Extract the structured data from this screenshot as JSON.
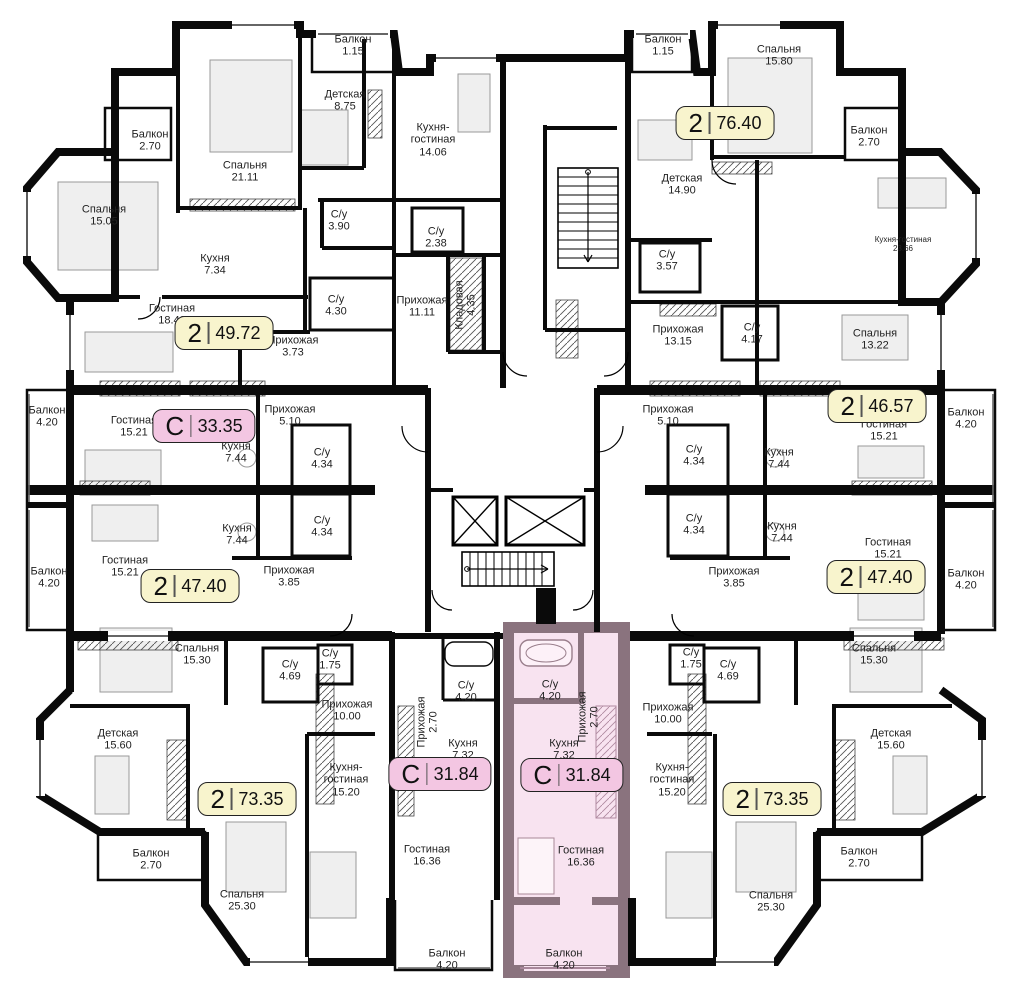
{
  "plan": {
    "name": "residential-floor-plan",
    "colors": {
      "walls": "#0a0a0a",
      "badge_two": "#f8f4cd",
      "badge_studio": "#f3c6e2",
      "highlight_fill": "#f8e3f0",
      "highlight_wall": "#8a737e"
    },
    "badges": [
      {
        "type": "2",
        "area": "49.72",
        "x": 224,
        "y": 333,
        "variant": "two",
        "highlighted": false
      },
      {
        "type": "С",
        "area": "33.35",
        "x": 204,
        "y": 426,
        "variant": "studio",
        "highlighted": false
      },
      {
        "type": "2",
        "area": "47.40",
        "x": 190,
        "y": 586,
        "variant": "two",
        "highlighted": false
      },
      {
        "type": "2",
        "area": "76.40",
        "x": 725,
        "y": 123,
        "variant": "two",
        "highlighted": false
      },
      {
        "type": "2",
        "area": "46.57",
        "x": 877,
        "y": 406,
        "variant": "two",
        "highlighted": false
      },
      {
        "type": "2",
        "area": "47.40",
        "x": 876,
        "y": 577,
        "variant": "two",
        "highlighted": false
      },
      {
        "type": "2",
        "area": "73.35",
        "x": 247,
        "y": 799,
        "variant": "two",
        "highlighted": false
      },
      {
        "type": "С",
        "area": "31.84",
        "x": 440,
        "y": 774,
        "variant": "studio",
        "highlighted": false
      },
      {
        "type": "С",
        "area": "31.84",
        "x": 572,
        "y": 775,
        "variant": "studio",
        "highlighted": true
      },
      {
        "type": "2",
        "area": "73.35",
        "x": 772,
        "y": 799,
        "variant": "two",
        "highlighted": false
      }
    ],
    "rooms": [
      {
        "name": "Балкон",
        "area": "2.70",
        "x": 150,
        "y": 141
      },
      {
        "name": "Спальня",
        "area": "21.11",
        "x": 245,
        "y": 172
      },
      {
        "name": "Спальня",
        "area": "15.05",
        "x": 104,
        "y": 216
      },
      {
        "name": "Кухня",
        "area": "7.34",
        "x": 215,
        "y": 265
      },
      {
        "name": "Гостиная",
        "area": "18.49",
        "x": 172,
        "y": 315
      },
      {
        "name": "Прихожая",
        "area": "3.73",
        "x": 293,
        "y": 347
      },
      {
        "name": "Балкон",
        "area": "1.15",
        "x": 353,
        "y": 46
      },
      {
        "name": "Детская",
        "area": "8.75",
        "x": 345,
        "y": 101
      },
      {
        "name": "Кухня-\nгостиная",
        "area": "14.06",
        "x": 433,
        "y": 140
      },
      {
        "name": "С/у",
        "area": "3.90",
        "x": 339,
        "y": 221
      },
      {
        "name": "С/у",
        "area": "2.38",
        "x": 436,
        "y": 238
      },
      {
        "name": "С/у",
        "area": "4.30",
        "x": 336,
        "y": 306
      },
      {
        "name": "Прихожая",
        "area": "11.11",
        "x": 422,
        "y": 307
      },
      {
        "name": "Кладовая",
        "area": "4.35",
        "x": 466,
        "y": 305,
        "vertical": true
      },
      {
        "name": "Балкон",
        "area": "1.15",
        "x": 663,
        "y": 46
      },
      {
        "name": "Детская",
        "area": "14.90",
        "x": 682,
        "y": 185
      },
      {
        "name": "С/у",
        "area": "3.57",
        "x": 667,
        "y": 261
      },
      {
        "name": "Спальня",
        "area": "15.80",
        "x": 779,
        "y": 56
      },
      {
        "name": "Балкон",
        "area": "2.70",
        "x": 869,
        "y": 137
      },
      {
        "name": "Кухня-гостиная",
        "area": "23.66",
        "x": 903,
        "y": 245,
        "small": true
      },
      {
        "name": "Прихожая",
        "area": "13.15",
        "x": 678,
        "y": 336
      },
      {
        "name": "С/у",
        "area": "4.17",
        "x": 752,
        "y": 334
      },
      {
        "name": "Прихожая",
        "area": "5.10",
        "x": 668,
        "y": 416
      },
      {
        "name": "С/у",
        "area": "4.34",
        "x": 694,
        "y": 456
      },
      {
        "name": "Кухня",
        "area": "7.44",
        "x": 779,
        "y": 459
      },
      {
        "name": "Спальня",
        "area": "13.22",
        "x": 875,
        "y": 340
      },
      {
        "name": "Гостиная",
        "area": "15.21",
        "x": 884,
        "y": 431
      },
      {
        "name": "Балкон",
        "area": "4.20",
        "x": 966,
        "y": 419
      },
      {
        "name": "С/у",
        "area": "4.34",
        "x": 694,
        "y": 525
      },
      {
        "name": "Кухня",
        "area": "7.44",
        "x": 782,
        "y": 533
      },
      {
        "name": "Гостиная",
        "area": "15.21",
        "x": 888,
        "y": 549
      },
      {
        "name": "Прихожая",
        "area": "3.85",
        "x": 734,
        "y": 578
      },
      {
        "name": "Балкон",
        "area": "4.20",
        "x": 966,
        "y": 580
      },
      {
        "name": "Балкон",
        "area": "4.20",
        "x": 47,
        "y": 417
      },
      {
        "name": "Гостиная",
        "area": "15.21",
        "x": 134,
        "y": 427
      },
      {
        "name": "Кухня",
        "area": "7.44",
        "x": 236,
        "y": 453
      },
      {
        "name": "С/у",
        "area": "4.34",
        "x": 322,
        "y": 459
      },
      {
        "name": "Прихожая",
        "area": "5.10",
        "x": 290,
        "y": 416
      },
      {
        "name": "Балкон",
        "area": "4.20",
        "x": 49,
        "y": 578
      },
      {
        "name": "Гостиная",
        "area": "15.21",
        "x": 125,
        "y": 567
      },
      {
        "name": "Кухня",
        "area": "7.44",
        "x": 237,
        "y": 535
      },
      {
        "name": "С/у",
        "area": "4.34",
        "x": 322,
        "y": 527
      },
      {
        "name": "Прихожая",
        "area": "3.85",
        "x": 289,
        "y": 577
      },
      {
        "name": "Спальня",
        "area": "15.30",
        "x": 197,
        "y": 655
      },
      {
        "name": "Детская",
        "area": "15.60",
        "x": 118,
        "y": 740
      },
      {
        "name": "Балкон",
        "area": "2.70",
        "x": 151,
        "y": 860
      },
      {
        "name": "Спальня",
        "area": "25.30",
        "x": 242,
        "y": 901
      },
      {
        "name": "С/у",
        "area": "4.69",
        "x": 290,
        "y": 671
      },
      {
        "name": "С/у",
        "area": "1.75",
        "x": 330,
        "y": 660
      },
      {
        "name": "Прихожая",
        "area": "10.00",
        "x": 347,
        "y": 711
      },
      {
        "name": "Кухня-\nгостиная",
        "area": "15.20",
        "x": 346,
        "y": 780
      },
      {
        "name": "С/у",
        "area": "4.20",
        "x": 466,
        "y": 692
      },
      {
        "name": "Прихожая",
        "area": "2.70",
        "x": 428,
        "y": 722,
        "vertical": true
      },
      {
        "name": "Кухня",
        "area": "7.32",
        "x": 463,
        "y": 750
      },
      {
        "name": "Гостиная",
        "area": "16.36",
        "x": 427,
        "y": 856
      },
      {
        "name": "Балкон",
        "area": "4.20",
        "x": 447,
        "y": 960
      },
      {
        "name": "С/у",
        "area": "4.20",
        "x": 550,
        "y": 691
      },
      {
        "name": "Прихожая",
        "area": "2.70",
        "x": 589,
        "y": 717,
        "vertical": true
      },
      {
        "name": "Кухня",
        "area": "7.32",
        "x": 564,
        "y": 750
      },
      {
        "name": "Гостиная",
        "area": "16.36",
        "x": 581,
        "y": 857
      },
      {
        "name": "Балкон",
        "area": "4.20",
        "x": 564,
        "y": 960
      },
      {
        "name": "С/у",
        "area": "1.75",
        "x": 691,
        "y": 659
      },
      {
        "name": "С/у",
        "area": "4.69",
        "x": 728,
        "y": 671
      },
      {
        "name": "Прихожая",
        "area": "10.00",
        "x": 668,
        "y": 714
      },
      {
        "name": "Кухня-\nгостиная",
        "area": "15.20",
        "x": 672,
        "y": 780
      },
      {
        "name": "Спальня",
        "area": "25.30",
        "x": 771,
        "y": 902
      },
      {
        "name": "Спальня",
        "area": "15.30",
        "x": 874,
        "y": 655
      },
      {
        "name": "Детская",
        "area": "15.60",
        "x": 891,
        "y": 740
      },
      {
        "name": "Балкон",
        "area": "2.70",
        "x": 859,
        "y": 858
      }
    ]
  }
}
